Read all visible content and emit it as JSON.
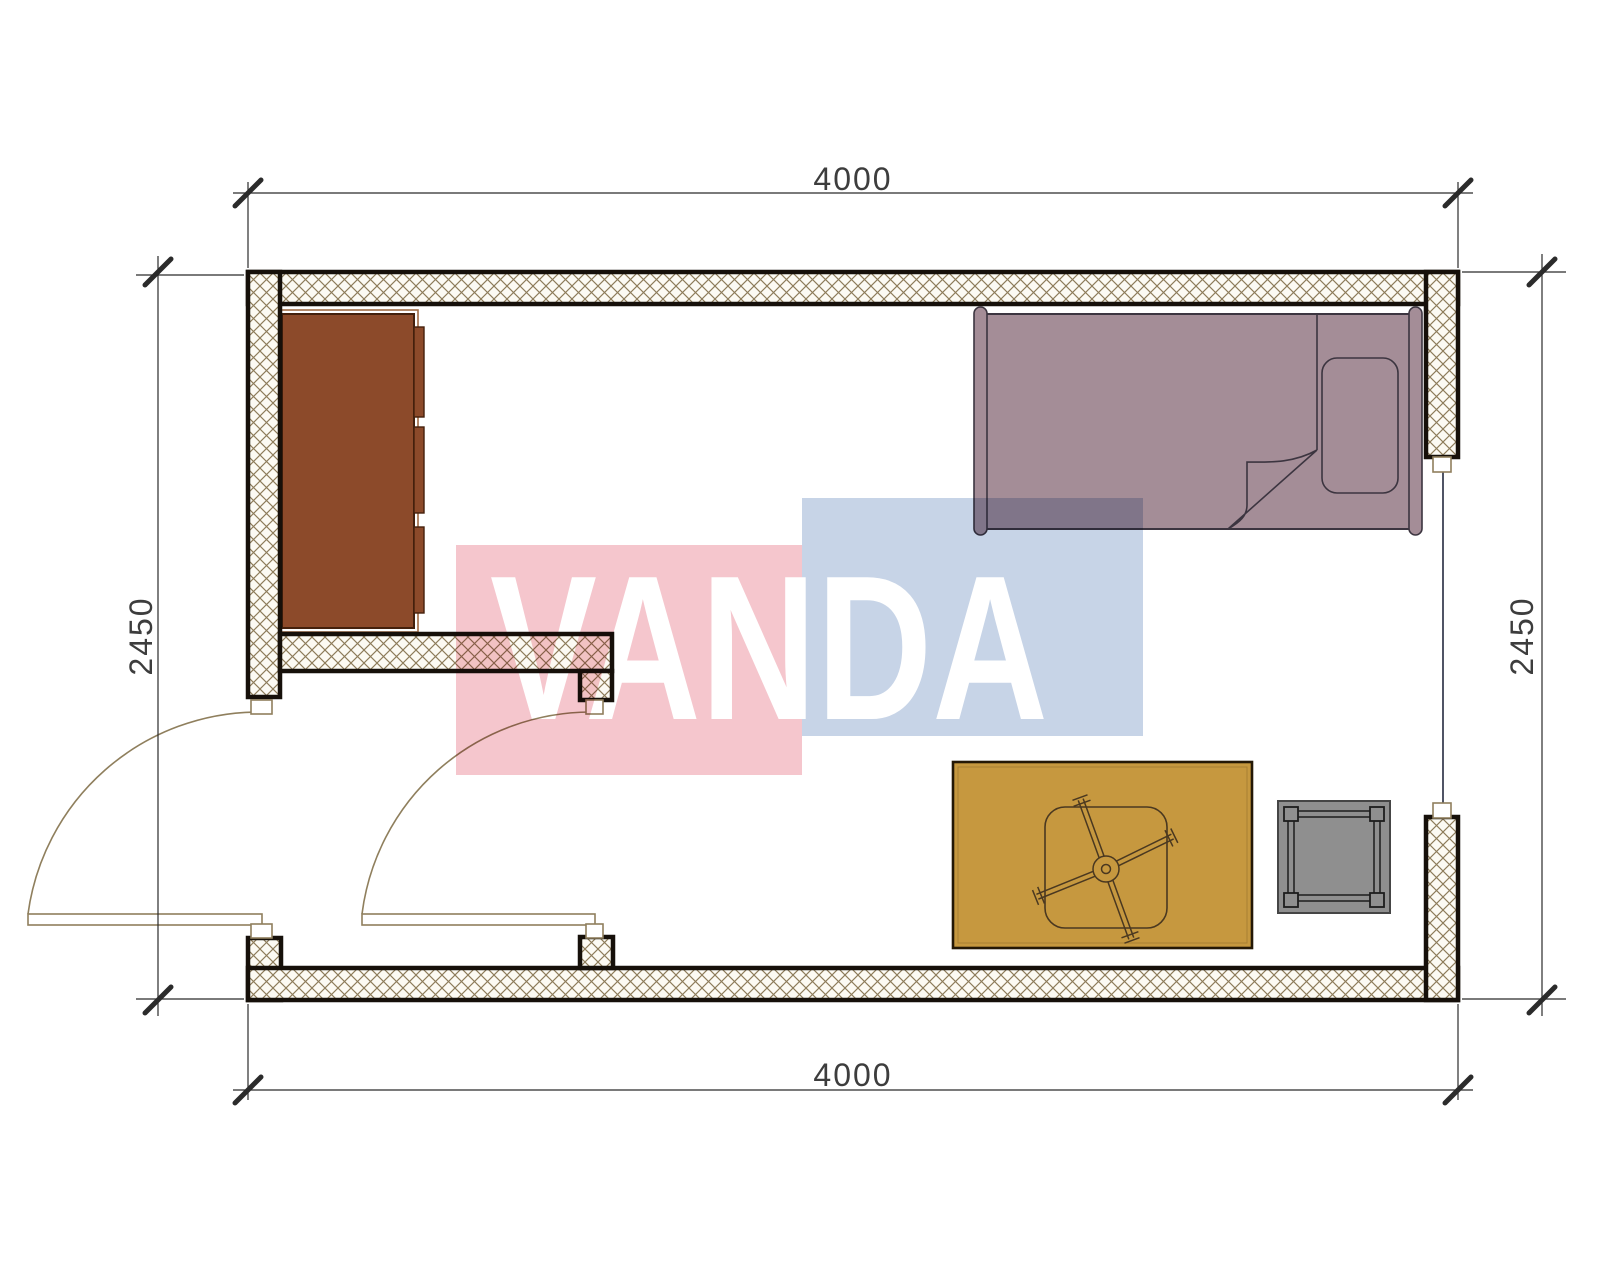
{
  "title": "Room floor plan",
  "watermark": {
    "text": "VANDA"
  },
  "dimensions": {
    "top": {
      "label": "4000"
    },
    "bottom": {
      "label": "4000"
    },
    "left": {
      "label": "2450"
    },
    "right": {
      "label": "2450"
    }
  },
  "plan": {
    "doors": 2,
    "windows": 1,
    "furniture": [
      {
        "name": "dresser",
        "color": "#8c4a2a"
      },
      {
        "name": "bed",
        "color": "#a48d97"
      },
      {
        "name": "table",
        "color": "#c6983f"
      },
      {
        "name": "stool",
        "color": "#8f8f8f"
      }
    ]
  },
  "colors": {
    "wall-line": "#16100a",
    "hatch-line": "#8d7c5a",
    "wall-bg": "#fcfaf3",
    "door-line": "#8f7f5d",
    "window-line": "#3c4254",
    "dim-line": "#2b2b2b",
    "dim-text": "#3d3d3d",
    "dresser-fill": "#8c4a2a",
    "dresser-line": "#44200c",
    "dresser-frame": "#a06a44",
    "bed-fill": "#a48d97",
    "bed-line": "#3c3540",
    "table-fill": "#c6983f",
    "table-line": "#241806",
    "table-detail": "#4a3820",
    "stool-fill": "#8f8f8f",
    "stool-line": "#454545",
    "wm-pink": "#f5c6cd",
    "wm-blue": "#c7d4e7",
    "wm-text": "#ffffff"
  }
}
